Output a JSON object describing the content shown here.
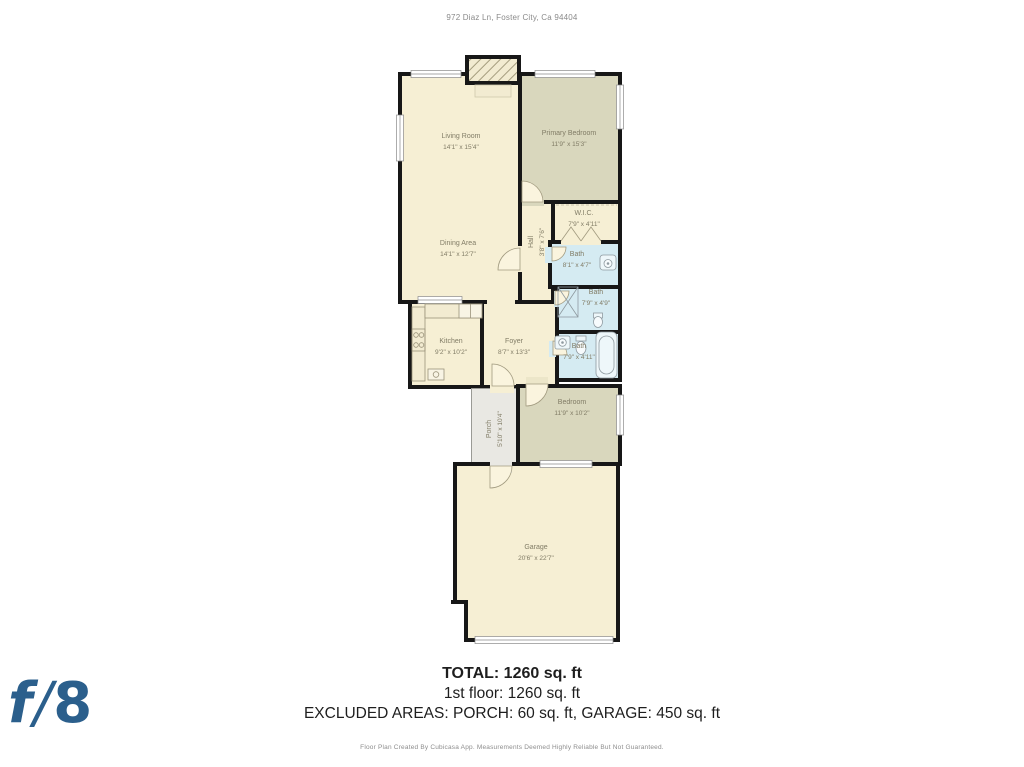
{
  "header": {
    "address": "972 Diaz Ln, Foster City, Ca 94404"
  },
  "summary": {
    "total": "TOTAL: 1260 sq. ft",
    "floor1": "1st floor: 1260 sq. ft",
    "excluded": "EXCLUDED AREAS: PORCH: 60 sq. ft, GARAGE: 450 sq. ft"
  },
  "footer": {
    "disclaimer": "Floor Plan Created By Cubicasa App. Measurements Deemed Highly Reliable But Not Guaranteed."
  },
  "logo": {
    "f": "f",
    "slash": "/",
    "eight": "8"
  },
  "colors": {
    "floor_cream": "#f6efd4",
    "bedroom_khaki": "#d9d7bd",
    "bath_blue": "#d5ebf2",
    "porch_gray": "#e9e8e3",
    "wall_black": "#171717",
    "label_gray": "#817c66",
    "logo_blue": "#2b5f8c"
  },
  "rooms": [
    {
      "id": "living-room",
      "name": "Living Room",
      "dims": "14'1\" x 15'4\"",
      "box": [
        3,
        17,
        124,
        232
      ],
      "fill": "floor_cream",
      "label": [
        66,
        87
      ],
      "rot": 0
    },
    {
      "id": "dining-area",
      "name": "Dining Area",
      "dims": "14'1\" x 12'7\"",
      "box": null,
      "fill": null,
      "label": [
        63,
        194
      ],
      "rot": 0
    },
    {
      "id": "primary-bedroom",
      "name": "Primary Bedroom",
      "dims": "11'9\" x 15'3\"",
      "box": [
        123,
        17,
        104,
        132
      ],
      "fill": "bedroom_khaki",
      "label": [
        174,
        84
      ],
      "rot": 0
    },
    {
      "id": "hall",
      "name": "Hall",
      "dims": "3'8\" x 7'6\"",
      "box": [
        123,
        145,
        37,
        104
      ],
      "fill": "floor_cream",
      "label": [
        142,
        187
      ],
      "rot": -90
    },
    {
      "id": "wic",
      "name": "W.I.C.",
      "dims": "7'9\" x 4'11\"",
      "box": [
        156,
        145,
        71,
        44
      ],
      "fill": "floor_cream",
      "label": [
        189,
        164
      ],
      "rot": 0
    },
    {
      "id": "bath-primary",
      "name": "Bath",
      "dims": "8'1\" x 4'7\"",
      "box": [
        153,
        185,
        74,
        49
      ],
      "fill": "bath_blue",
      "label": [
        182,
        205
      ],
      "rot": 0
    },
    {
      "id": "bath-middle",
      "name": "Bath",
      "dims": "7'9\" x 4'9\"",
      "box": [
        160,
        230,
        67,
        49
      ],
      "fill": "bath_blue",
      "label": [
        201,
        243
      ],
      "rot": 0
    },
    {
      "id": "bath-lower",
      "name": "Bath",
      "dims": "7'9\" x 4'11\"",
      "box": [
        155,
        275,
        72,
        52
      ],
      "fill": "bath_blue",
      "label": [
        184,
        297
      ],
      "rot": 0
    },
    {
      "id": "kitchen",
      "name": "Kitchen",
      "dims": "9'2\" x 10'2\"",
      "box": [
        13,
        245,
        76,
        89
      ],
      "fill": "floor_cream",
      "label": [
        56,
        292
      ],
      "rot": 0
    },
    {
      "id": "foyer",
      "name": "Foyer",
      "dims": "8'7\" x 13'3\"",
      "box": [
        85,
        245,
        79,
        89
      ],
      "fill": "floor_cream",
      "label": [
        119,
        292
      ],
      "rot": 0
    },
    {
      "id": "porch",
      "name": "Porch",
      "dims": "5'10\" x 10'4\"",
      "box": [
        76,
        333,
        49,
        84
      ],
      "fill": "porch_gray",
      "label": [
        100,
        374
      ],
      "rot": -90,
      "outdoor": true
    },
    {
      "id": "bedroom",
      "name": "Bedroom",
      "dims": "11'9\" x 10'2\"",
      "box": [
        121,
        329,
        106,
        82
      ],
      "fill": "bedroom_khaki",
      "label": [
        177,
        353
      ],
      "rot": 0
    },
    {
      "id": "garage",
      "name": "Garage",
      "dims": "20'6\" x 22'7\"",
      "box": [
        58,
        407,
        167,
        180
      ],
      "fill": "floor_cream",
      "label": [
        141,
        498
      ],
      "rot": 0
    }
  ]
}
